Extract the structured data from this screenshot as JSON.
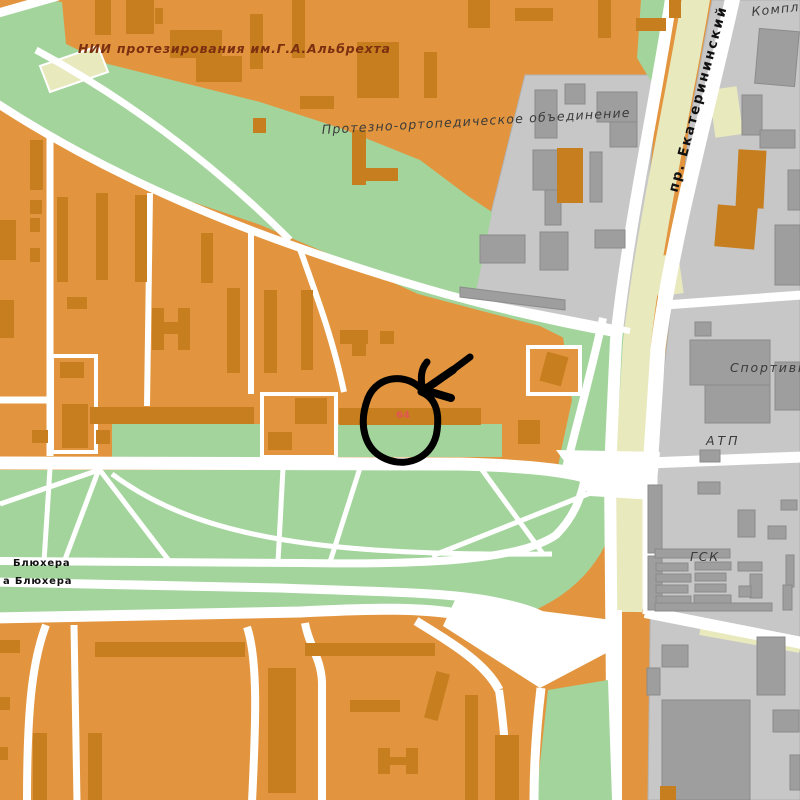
{
  "map": {
    "labels": {
      "institute": "НИИ протезирования им.Г.А.Альбрехта",
      "association": "Протезно-ортопедическое объединение",
      "prospekt": "пр. Екатерининский",
      "kompl": "Компл",
      "sportivn": "Спортивн",
      "atp": "АТП",
      "gsk": "ГСК",
      "blyukhera_upper": "Блюхера",
      "blyukhera_lower": "а Блюхера",
      "house_number": "64"
    },
    "colors": {
      "block_orange": "#E2953E",
      "building_orange": "#C67E1E",
      "green": "#A3D49C",
      "gray_bg": "#C7C7C7",
      "gray_outline": "#B2B2B2",
      "gray_building": "#9E9E9E",
      "gray_building_outline": "#8B8B8B",
      "cream": "#E9E9BE",
      "road": "#FFFFFF",
      "label_maroon": "#7B2F10",
      "label_dark": "#3A3A3A",
      "label_black": "#111111",
      "house_red": "#E25552",
      "annotation": "#000000"
    }
  }
}
